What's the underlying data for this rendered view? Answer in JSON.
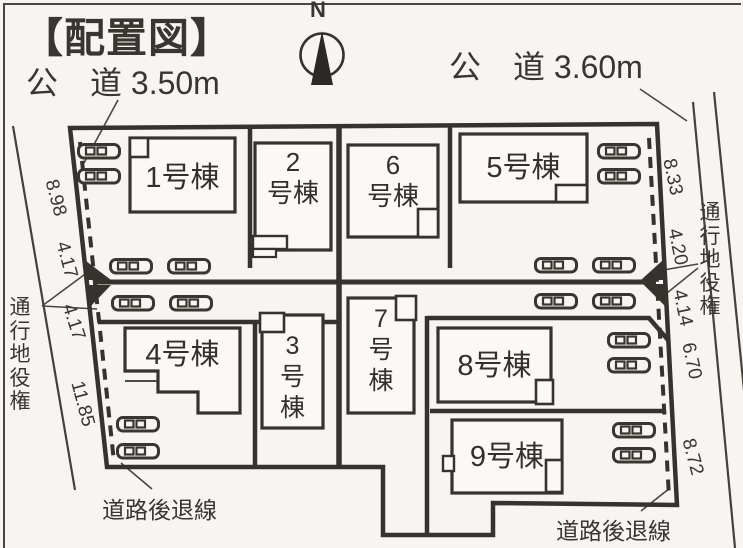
{
  "page": {
    "title": "【配置図】",
    "north_label": "N"
  },
  "roads": {
    "left_label": "公　道 3.50m",
    "right_label": "公　道 3.60m"
  },
  "buildings": {
    "b1": {
      "label": "1号棟"
    },
    "b2": {
      "label": "2\n号棟"
    },
    "b3": {
      "label": "3\n号\n棟"
    },
    "b4": {
      "label": "4号棟"
    },
    "b5": {
      "label": "5号棟"
    },
    "b6": {
      "label": "6\n号棟"
    },
    "b7": {
      "label": "7\n号\n棟"
    },
    "b8": {
      "label": "8号棟"
    },
    "b9": {
      "label": "9号棟"
    }
  },
  "measurements": {
    "left": [
      {
        "value": "8.98"
      },
      {
        "value": "4.17"
      },
      {
        "value": "4.17"
      },
      {
        "value": "11.85"
      }
    ],
    "right": [
      {
        "value": "8.33"
      },
      {
        "value": "4.20"
      },
      {
        "value": "4.14"
      },
      {
        "value": "6.70"
      },
      {
        "value": "8.72"
      }
    ]
  },
  "easements": {
    "left": "通\n行\n地\n役\n権",
    "right": "通\n行\n地\n役\n権"
  },
  "setbacks": {
    "left": "道路後退線",
    "right": "道路後退線"
  },
  "icons": {
    "car": "car-icon",
    "compass": "north-compass-icon"
  },
  "colors": {
    "ink": "#3a3531",
    "paper": "#f6f5f1",
    "building_fill": "#faf9f6"
  }
}
